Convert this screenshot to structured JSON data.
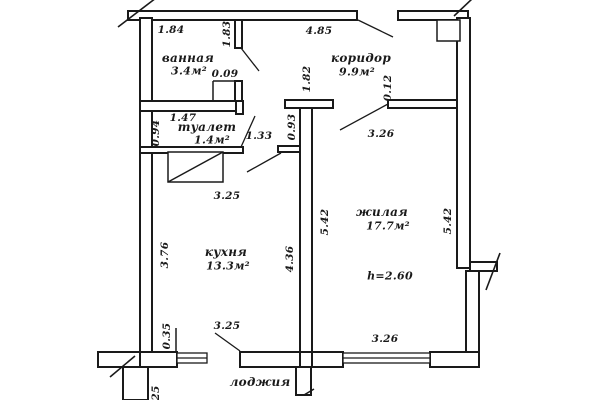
{
  "plan": {
    "rooms": {
      "bathroom": {
        "name": "ванная",
        "area": "3.4м²"
      },
      "corridor": {
        "name": "коридор",
        "area": "9.9м²"
      },
      "toilet": {
        "name": "туалет",
        "area": "1.4м²"
      },
      "kitchen": {
        "name": "кухня",
        "area": "13.3м²"
      },
      "living": {
        "name": "жилая",
        "area": "17.7м²",
        "ceiling_height": "h=2.60"
      },
      "loggia": {
        "name": "лоджия"
      }
    },
    "dims": {
      "bath_top": "1.84",
      "corridor_top": "4.85",
      "bath_left": "1.83",
      "bath_offset": "0.09",
      "corridor_left": "1.82",
      "living_stub": "0.12",
      "toilet_top": "1.47",
      "toilet_left": "0.94",
      "passage": "0.93",
      "niche": "1.33",
      "living_top": "3.26",
      "living_bottom": "3.26",
      "living_left": "5.42",
      "living_right": "5.42",
      "kitchen_top": "3.25",
      "kitchen_bottom": "3.25",
      "kitchen_left": "3.76",
      "kitchen_right": "4.36",
      "kitchen_sill": "0.35",
      "loggia_partial": "25"
    },
    "colors": {
      "line": "#1a1a1a",
      "background": "#ffffff"
    }
  }
}
